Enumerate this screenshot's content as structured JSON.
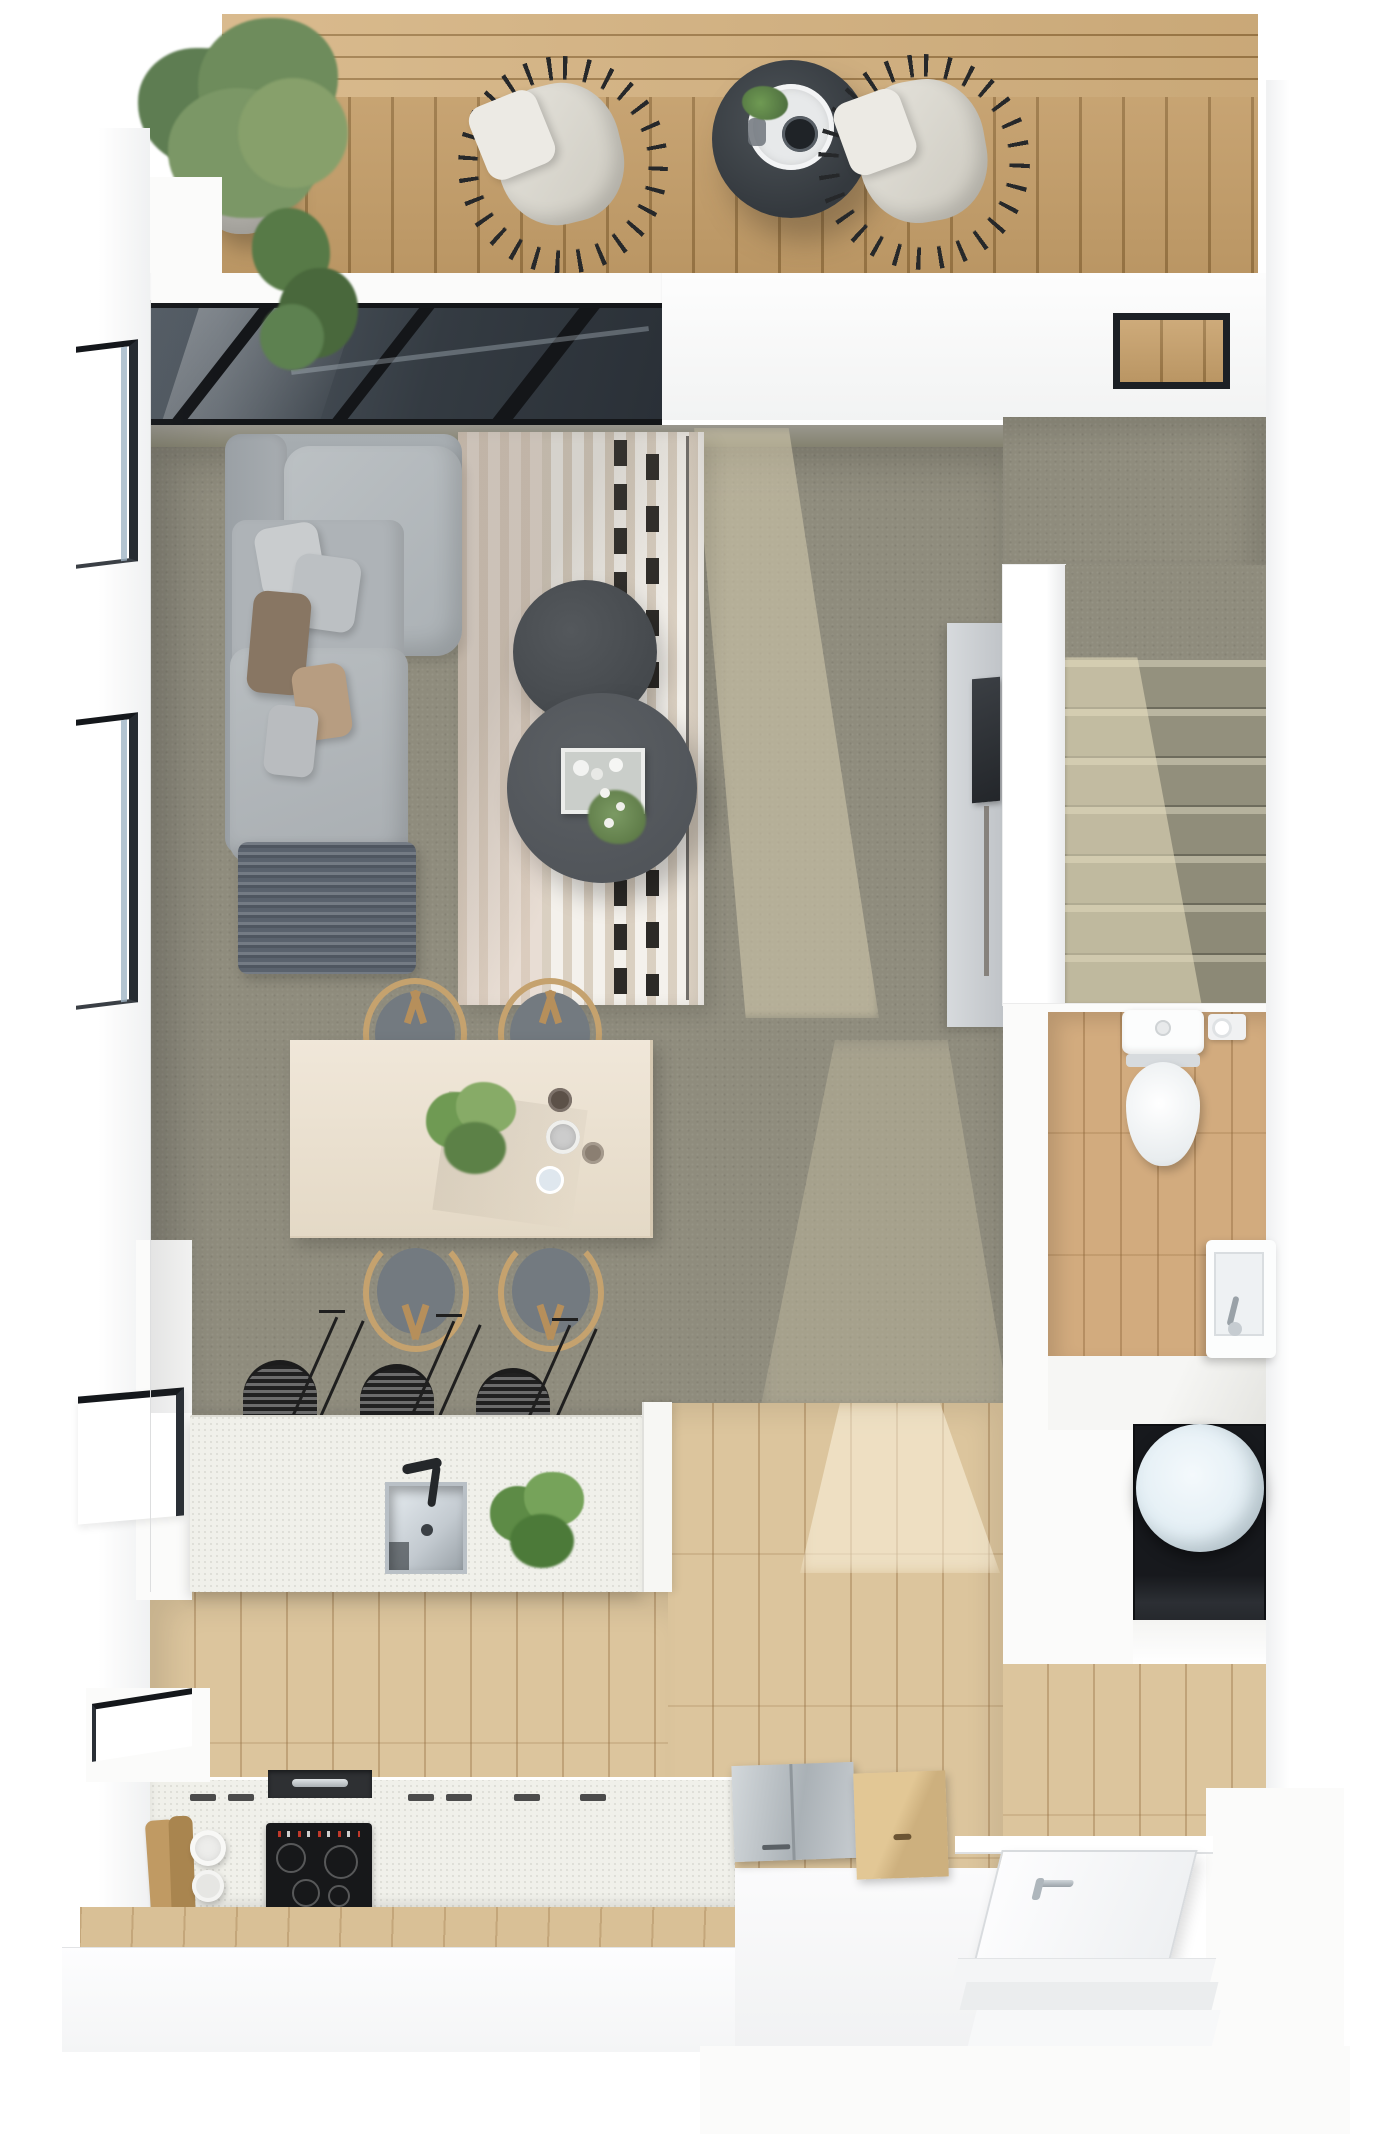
{
  "scene": {
    "type": "3d-floor-plan-top-down-render",
    "description": "Photorealistic top-down 3D floor plan of a studio apartment with roof terrace, living room under a glass skylight, dining area, kitchen, staircase, bathroom and utility closet",
    "rooms": [
      {
        "name": "roof-terrace",
        "floor": "wood-decking",
        "furniture": [
          "large-potted-plant",
          "small-potted-plant",
          "wicker-lounge-chair-left",
          "wicker-lounge-chair-right",
          "round-side-table",
          "serving-tray",
          "coffee-cup",
          "table-plant"
        ]
      },
      {
        "name": "living-room",
        "floor": "grey-carpet",
        "furniture": [
          "l-shaped-sectional-sofa",
          "throw-pillows",
          "throw-blanket",
          "striped-area-rug",
          "round-coffee-table-small",
          "round-coffee-table-large",
          "decor-tray-with-flowers",
          "media-panel",
          "wall-mounted-tv"
        ]
      },
      {
        "name": "dining-area",
        "floor": "grey-carpet",
        "furniture": [
          "rectangular-dining-table",
          "wishbone-chair x4",
          "centerpiece-plant",
          "cups-and-bowls"
        ]
      },
      {
        "name": "kitchen",
        "floor": "light-oak-plank",
        "furniture": [
          "island-with-sink",
          "black-faucet",
          "potted-monstera",
          "bar-stool x3",
          "perimeter-counter",
          "induction-cooktop",
          "cabinet-handles",
          "cutting-boards",
          "paper-towel-rolls",
          "steel-appliance-lid",
          "wood-appliance-lid"
        ]
      },
      {
        "name": "staircase",
        "floor": "grey-carpet-treads",
        "details": [
          "seven-treads",
          "sunlit-patch"
        ]
      },
      {
        "name": "bathroom",
        "floor": "oak-plank",
        "furniture": [
          "toilet",
          "toilet-paper-holder",
          "compact-wall-sink"
        ]
      },
      {
        "name": "utility-closet",
        "furniture": [
          "round-water-tank"
        ]
      },
      {
        "name": "entry",
        "furniture": [
          "entry-door-white",
          "chrome-door-handle",
          "entry-steps"
        ]
      }
    ],
    "windows": [
      "upper-left-slit-window",
      "middle-left-slit-window",
      "lower-left-window",
      "kitchen-corner-window",
      "clerestory-terrace-window",
      "glass-skylight-roof"
    ]
  },
  "palette": {
    "page": "#ffffff",
    "wall": "#fbfbfa",
    "wall_shade": "#e9eaeb",
    "deck_wood": "#c8a16b",
    "deck_wood_dark": "#9f7a47",
    "deck_wood_light": "#d4b17e",
    "glass_dark": "#3c444c",
    "glass_deep": "#20262c",
    "beam_black": "#141619",
    "carpet": "#8f8c7d",
    "carpet_sun": "#d6cdaf",
    "rug_base": "#e7e0d4",
    "rug_pink": "#dccabb",
    "rug_dash": "#2c2a27",
    "sofa_base": "#a6acb0",
    "sofa_light": "#b7bcc0",
    "pillow_grey": "#c9ccce",
    "pillow_brown": "#887663",
    "pillow_tan": "#b79d81",
    "blanket": "#5a626d",
    "table_dark_small": "#45494d",
    "table_dark_large": "#51555a",
    "wood_floor": "#dcc59d",
    "bath_wood": "#d2ab7e",
    "island_white": "#f0f0ea",
    "steel": "#c3c8cc",
    "cooktop": "#17181a",
    "stool_black": "#26282a",
    "chair_wood": "#c5a26e",
    "chair_seat": "#737a80",
    "dining_wood": "#ece2d2",
    "plant_green": "#6f9a53",
    "plant_dark": "#49683c",
    "fixture_white": "#fcfdfd",
    "boiler_blue": "#e4eff5",
    "closet_dark": "#17191d",
    "tv_dark": "#2f3337",
    "media_panel": "#ccd0d4",
    "window_frame": "#1c2025"
  }
}
